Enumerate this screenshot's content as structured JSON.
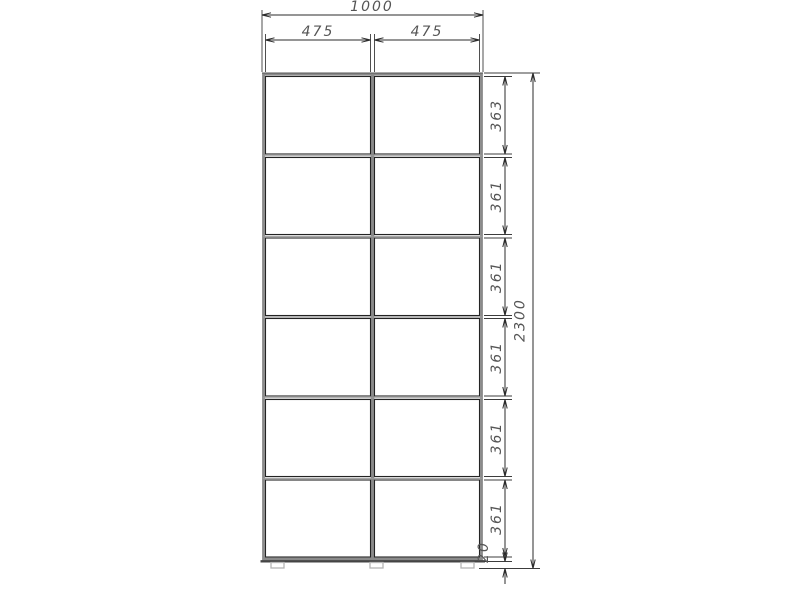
{
  "drawing": {
    "kind": "furniture-front-elevation-technical-drawing",
    "object": "two-section six-row wardrobe / shelving carcass with dimension chains",
    "grid": {
      "columns": 2,
      "rows": 6
    },
    "dimensions": {
      "overall_width": "1000",
      "column_widths": [
        "475",
        "475"
      ],
      "overall_height": "2300",
      "cell_heights": [
        "363",
        "361",
        "361",
        "361",
        "361",
        "361"
      ],
      "bottom_clearance": "20"
    },
    "colors": {
      "background": "#ffffff",
      "panel_gray": "#8a8a8a",
      "cell_outline": "#232323",
      "dim_line": "#2b2b2b",
      "dim_text": "#555555",
      "foot_outline": "#b5b5b5"
    }
  }
}
